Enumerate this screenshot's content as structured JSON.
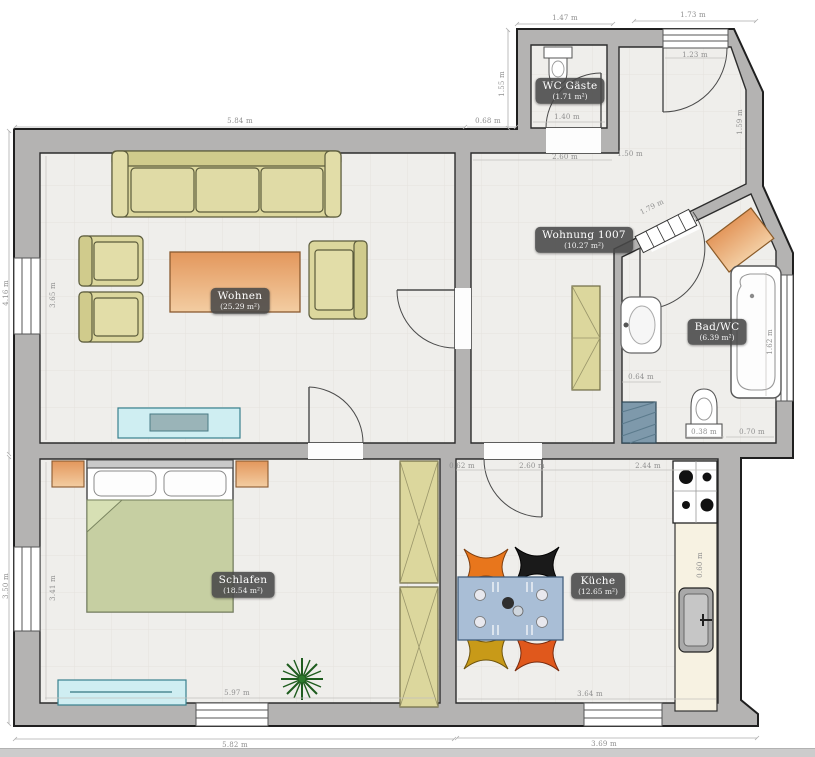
{
  "rooms": {
    "wohnen": {
      "name": "Wohnen",
      "area": "(25.29 m²)"
    },
    "schlafen": {
      "name": "Schlafen",
      "area": "(18.54 m²)"
    },
    "kueche": {
      "name": "Küche",
      "area": "(12.65 m²)"
    },
    "bad": {
      "name": "Bad/WC",
      "area": "(6.39 m²)"
    },
    "wc_gaeste": {
      "name": "WC Gäste",
      "area": "(1.71 m²)"
    },
    "flur": {
      "name": "Wohnung 1007",
      "area": "(10.27 m²)"
    }
  },
  "dims": {
    "top_main": "5.84 m",
    "top_step": "0.68 m",
    "wc_top": "1.47 m",
    "entry_top": "1.73 m",
    "tower_left": "1.55 m",
    "left_upper": "4.16 m",
    "left_lower": "3.50 m",
    "bottom_left": "5.82 m",
    "bottom_right": "3.69 m",
    "living_height": "3.65 m",
    "bedroom_height": "3.41 m",
    "bedroom_width": "5.97 m",
    "kitchen_width": "3.64 m",
    "kitchen_top_left": "0.62 m",
    "kitchen_top_mid": "2.60 m",
    "kitchen_top_right": "2.44 m",
    "counter_depth": "0.60 m",
    "hall_width": "2.60 m",
    "hall_width2": "1.50 m",
    "wc_width": "1.40 m",
    "entry_width": "1.23 m",
    "entry_right": "1.59 m",
    "bath_door": "1.79 m",
    "bath_sink": "0.64 m",
    "tub_length": "1.62 m",
    "toilet_width": "0.38 m",
    "bath_bottom": "0.70 m"
  },
  "colors": {
    "wall": "#b4b3b2",
    "floor": "#efeeeb",
    "furniture_khaki": "#dcd79d",
    "accent_orange": "#e79e62",
    "lowboard_cyan": "#cfeef2",
    "duvet_green": "#c6cfa2",
    "table_blue": "#a9bed6",
    "chair_orange": "#e8761c",
    "chair_black": "#1a1a1a",
    "chair_mustard": "#c89a18",
    "chair_red": "#e0581c",
    "washer_blue": "#7e99ab",
    "label_bg": "#4d4d4d"
  }
}
